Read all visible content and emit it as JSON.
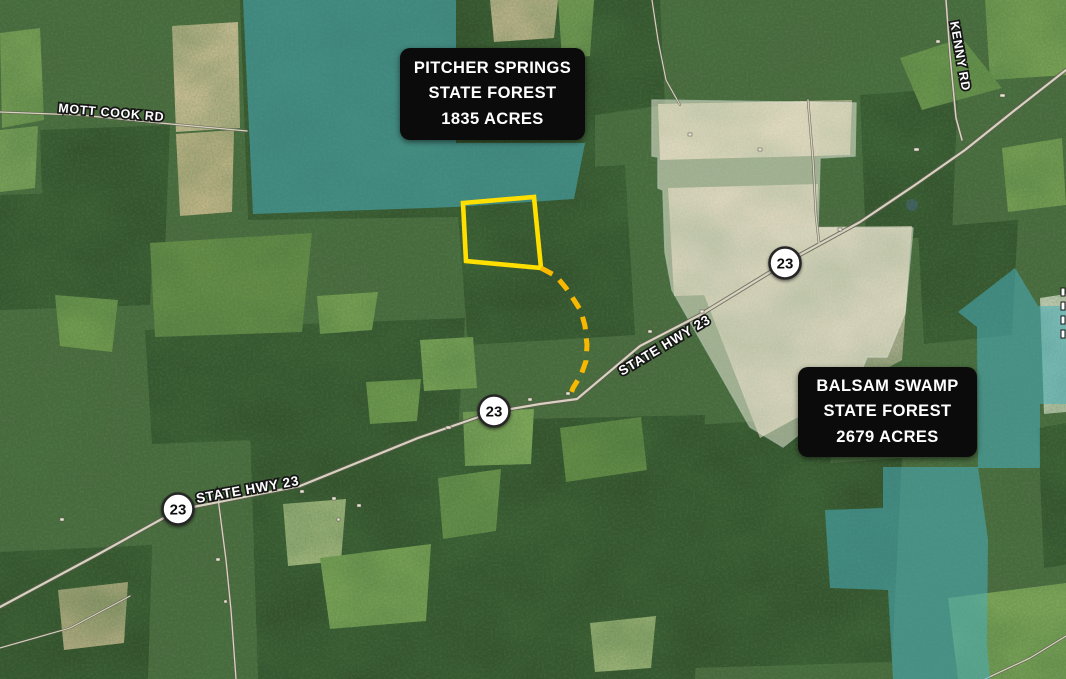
{
  "title_boxes": {
    "pitcher_springs": {
      "lines": [
        "PITCHER SPRINGS",
        "STATE FOREST",
        "1835 ACRES"
      ]
    },
    "balsam_swamp": {
      "lines": [
        "BALSAM SWAMP",
        "STATE FOREST",
        "2679 ACRES"
      ]
    }
  },
  "road_labels": {
    "mott_cook_rd": "MOTT COOK RD",
    "kenny_rd": "KENNY RD",
    "state_hwy_23_upper": "STATE HWY 23",
    "state_hwy_23_lower": "STATE HWY 23"
  },
  "route_shields": {
    "route_number": "23"
  },
  "colors": {
    "state_forest_overlay": "#49aebd",
    "white_parcel_overlay": "#f7f3e2",
    "proposed_parcel_outline": "#ffdf00",
    "access_route_dashed": "#f8b800",
    "label_box_bg": "#0b0b0b",
    "label_box_text": "#ffffff"
  }
}
